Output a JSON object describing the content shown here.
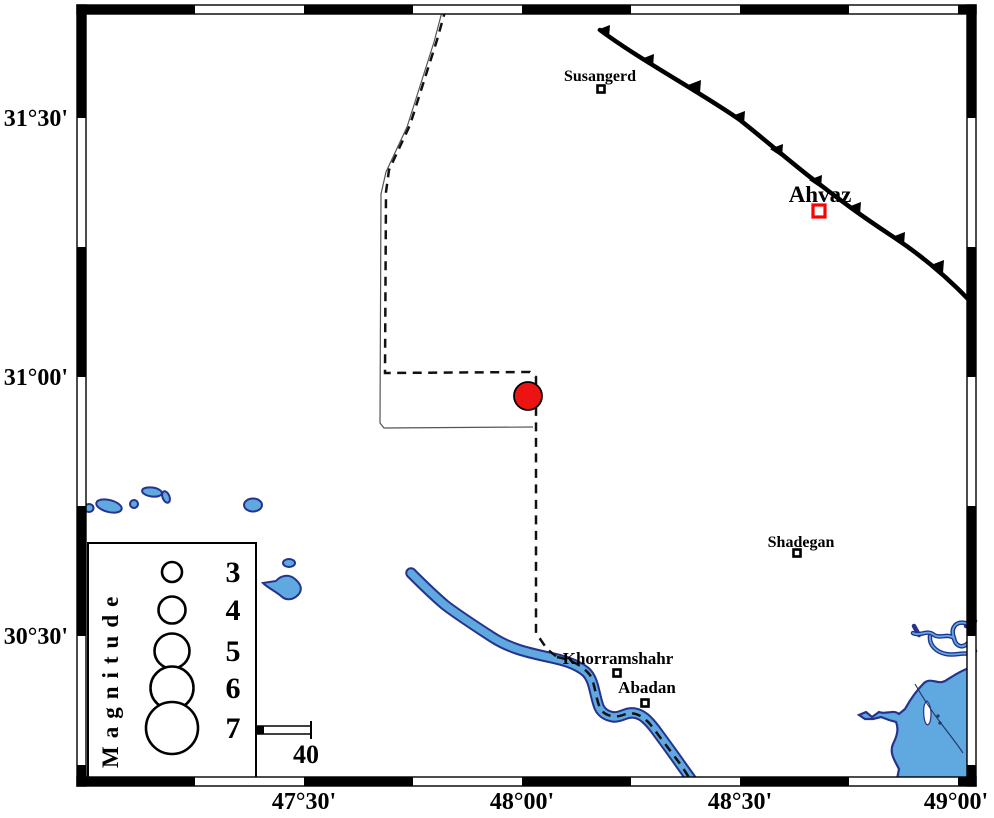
{
  "map_frame": {
    "x_axis_labels": [
      "47°30'",
      "48°00'",
      "48°30'",
      "49°00'"
    ],
    "y_axis_labels": [
      "31°30'",
      "31°00'",
      "30°30'"
    ]
  },
  "cities": {
    "susangerd": {
      "label": "Susangerd",
      "marker": "open-square-black"
    },
    "ahvaz": {
      "label": "Ahvaz",
      "marker": "open-square-red",
      "marker_color": "#ff0000"
    },
    "shadegan": {
      "label": "Shadegan",
      "marker": "open-square-black"
    },
    "khorramshahr": {
      "label": "Khorramshahr",
      "marker": "open-square-black"
    },
    "abadan": {
      "label": "Abadan",
      "marker": "open-square-black"
    }
  },
  "epicenter": {
    "symbol": "filled-circle",
    "color": "#ec1313"
  },
  "legend": {
    "title": "Magnitude",
    "magnitude_labels": [
      "3",
      "4",
      "5",
      "6",
      "7"
    ]
  },
  "scale_bar": {
    "label": "40"
  },
  "features": {
    "fault": "thrust-fault-with-teeth",
    "border": "dashed-international-border",
    "rivers": "karun-and-shatt-estuary"
  },
  "colors": {
    "water_fill": "#5fa8e0",
    "water_outline": "#25338f",
    "fault": "#000000",
    "frame": "#000000"
  }
}
